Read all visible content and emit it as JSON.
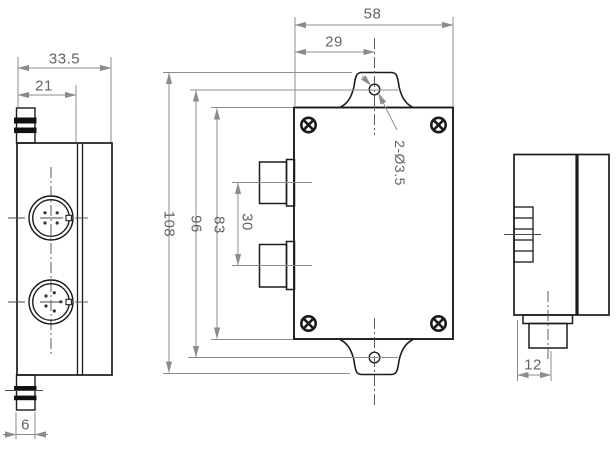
{
  "drawing": {
    "colors": {
      "outline": "#1b1b1b",
      "dimension_lines": "#8c8c8c",
      "dimension_text": "#636363",
      "screw_fill": "#111111"
    },
    "views": {
      "side_left": {
        "dims": {
          "overall_depth": "33.5",
          "body_depth": "21",
          "gland_width": "6"
        }
      },
      "front": {
        "dims": {
          "overall_width": "58",
          "hole_offset": "29",
          "overall_height": "108",
          "hole_spacing": "96",
          "body_height": "83",
          "connector_spacing": "30"
        },
        "hole_label": "2-Ø3.5"
      },
      "side_right": {
        "dims": {
          "connector_width": "12"
        }
      }
    },
    "icons": {
      "screw": "circle-with-cross",
      "mounting_hole": "small-circle"
    }
  }
}
